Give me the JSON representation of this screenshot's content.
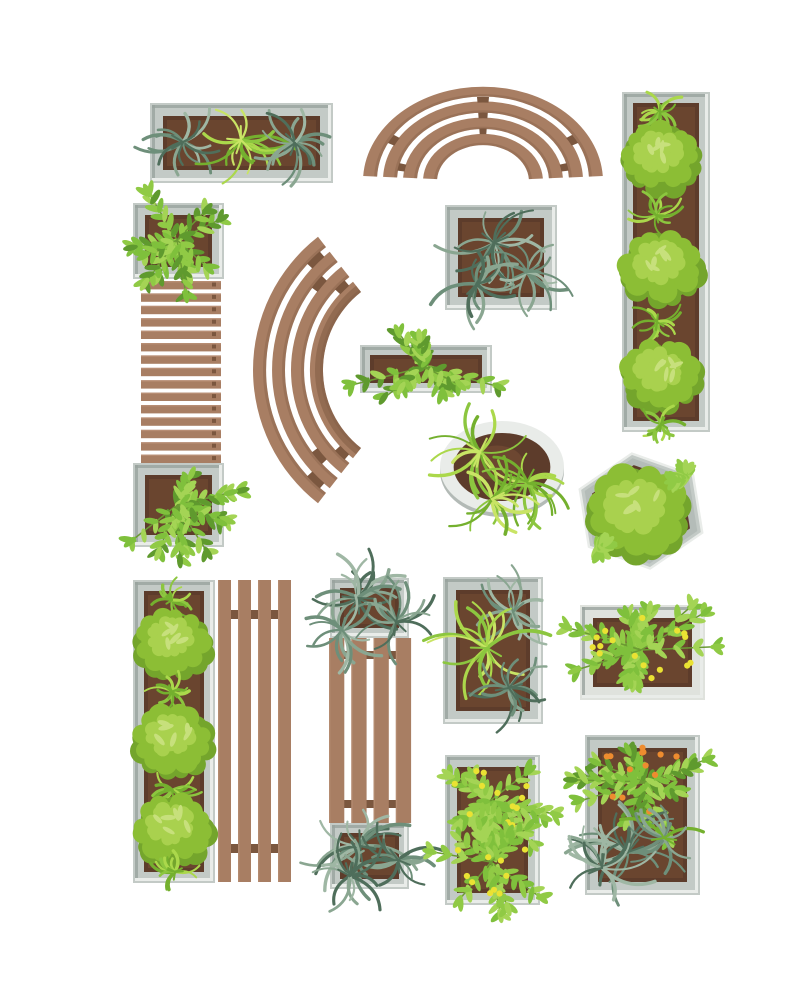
{
  "background": "#ffffff",
  "palette": {
    "wood": "#a87e63",
    "woodLight": "#bd947a",
    "woodDark": "#7b573f",
    "frame": "#c3cac6",
    "frameDark": "#99a39e",
    "frameHi": "#e9ece9",
    "frameWhite": "#dfe2dd",
    "soil": "#5d3c2b",
    "soilLight": "#7a5036",
    "bush": "#8cbe35",
    "bushDark": "#74a52c",
    "bushLight": "#a9d14e",
    "bushLeaf": "#c7e07c",
    "stem": "#6b9a33",
    "sage1": "#8aa691",
    "sage2": "#9fb7a4",
    "sage3": "#6e8f7a",
    "sage4": "#4f6e5b",
    "grass1": "#8cc63f",
    "grass2": "#abd84b",
    "grass3": "#74b02e",
    "grass4": "#c9e465",
    "leaf1": "#7fc03c",
    "leaf2": "#a4d455",
    "leaf3": "#5f9a2e",
    "leaf4": "#90ca45",
    "yellowBerry": "#eae233",
    "orangeBerry": "#ee8c2f"
  },
  "elements": [
    {
      "id": "planter-topleft-frame",
      "type": "rectPlanter",
      "x": 150,
      "y": 103,
      "w": 183,
      "h": 80,
      "inset": 13
    },
    {
      "id": "planter-topleft-plants",
      "type": "plants",
      "items": [
        {
          "kind": "spiky",
          "cx": 183,
          "cy": 142,
          "len": 46,
          "n": 16,
          "seed": 11,
          "colors": [
            "sage1",
            "sage2",
            "sage3",
            "sage4"
          ]
        },
        {
          "kind": "spiky",
          "cx": 241,
          "cy": 140,
          "len": 50,
          "n": 17,
          "seed": 12,
          "colors": [
            "grass1",
            "grass2",
            "grass3",
            "grass4"
          ]
        },
        {
          "kind": "spiky",
          "cx": 295,
          "cy": 143,
          "len": 46,
          "n": 16,
          "seed": 13,
          "colors": [
            "sage1",
            "sage2",
            "sage3",
            "sage4"
          ]
        }
      ]
    },
    {
      "id": "bench-arch",
      "type": "benchArc",
      "cx": 483,
      "cy": 181,
      "yscale": 0.79,
      "a0": 3,
      "a1": 177,
      "bands": [
        [
          120,
          106
        ],
        [
          100,
          86
        ],
        [
          80,
          66
        ],
        [
          60,
          46
        ]
      ],
      "ties": [
        {
          "gap": 0,
          "angles": [
            90,
            150,
            30
          ]
        },
        {
          "gap": 1,
          "angles": [
            90,
            168,
            12
          ]
        },
        {
          "gap": 2,
          "angles": [
            90
          ]
        }
      ]
    },
    {
      "id": "planter-tallright-frame",
      "type": "rectPlanter",
      "x": 622,
      "y": 92,
      "w": 88,
      "h": 340,
      "inset": 11
    },
    {
      "id": "planter-tallright-plants",
      "type": "plants",
      "items": [
        {
          "kind": "spiky",
          "cx": 660,
          "cy": 112,
          "len": 26,
          "n": 12,
          "seed": 21,
          "colors": [
            "grass1",
            "grass2",
            "grass3"
          ]
        },
        {
          "kind": "bush",
          "cx": 661,
          "cy": 158,
          "rx": 40,
          "ry": 33,
          "seed": 22
        },
        {
          "kind": "spiky",
          "cx": 656,
          "cy": 215,
          "len": 28,
          "n": 12,
          "seed": 23,
          "colors": [
            "grass1",
            "grass2",
            "grass3"
          ]
        },
        {
          "kind": "bush",
          "cx": 661,
          "cy": 268,
          "rx": 42,
          "ry": 34,
          "seed": 24
        },
        {
          "kind": "spiky",
          "cx": 657,
          "cy": 322,
          "len": 28,
          "n": 12,
          "seed": 25,
          "colors": [
            "grass1",
            "grass2",
            "grass3"
          ]
        },
        {
          "kind": "bush",
          "cx": 661,
          "cy": 375,
          "rx": 40,
          "ry": 33,
          "seed": 26
        },
        {
          "kind": "spiky",
          "cx": 661,
          "cy": 424,
          "len": 26,
          "n": 12,
          "seed": 27,
          "colors": [
            "grass1",
            "grass2",
            "grass3"
          ]
        }
      ]
    },
    {
      "id": "planter-left-top-frame",
      "type": "rectPlanter",
      "x": 133,
      "y": 203,
      "w": 91,
      "h": 76,
      "inset": 12
    },
    {
      "id": "planter-left-bottom-frame",
      "type": "rectPlanter",
      "x": 133,
      "y": 463,
      "w": 91,
      "h": 84,
      "inset": 12
    },
    {
      "id": "bench-straight-left",
      "type": "benchH",
      "x": 141,
      "y": 281,
      "w": 80,
      "h": 182,
      "slats": 15,
      "gap": 4,
      "nails": true
    },
    {
      "id": "planter-left-plants",
      "type": "plants",
      "items": [
        {
          "kind": "leafy",
          "cx": 177,
          "cy": 240,
          "rx": 52,
          "ry": 46,
          "branches": 10,
          "seed": 31,
          "colors": [
            "leaf1",
            "leaf2",
            "leaf3",
            "leaf4"
          ]
        },
        {
          "kind": "leafy",
          "cx": 177,
          "cy": 505,
          "rx": 52,
          "ry": 48,
          "branches": 10,
          "seed": 32,
          "colors": [
            "leaf1",
            "leaf2",
            "leaf3",
            "leaf4"
          ]
        }
      ]
    },
    {
      "id": "bench-curved",
      "type": "benchArc",
      "cx": 422,
      "cy": 370,
      "yscale": 1,
      "a0": 128,
      "a1": 232,
      "bands": [
        [
          169,
          156
        ],
        [
          150,
          137
        ],
        [
          131,
          118
        ],
        [
          112,
          99
        ]
      ],
      "ties": [
        {
          "gap": 0,
          "angles": [
            134,
            226
          ]
        },
        {
          "gap": 1,
          "angles": [
            140,
            220
          ]
        },
        {
          "gap": 2,
          "angles": [
            134,
            226
          ]
        }
      ],
      "innerShadow": [
        107,
        99
      ]
    },
    {
      "id": "planter-square-top-frame",
      "type": "rectPlanter",
      "x": 445,
      "y": 205,
      "w": 112,
      "h": 105,
      "inset": 13
    },
    {
      "id": "planter-square-top-plants",
      "type": "plants",
      "items": [
        {
          "kind": "spiky",
          "cx": 494,
          "cy": 243,
          "len": 54,
          "n": 17,
          "seed": 41,
          "colors": [
            "sage1",
            "sage2",
            "sage3",
            "sage4"
          ]
        },
        {
          "kind": "spiky",
          "cx": 527,
          "cy": 272,
          "len": 48,
          "n": 15,
          "seed": 42,
          "colors": [
            "sage1",
            "sage2",
            "sage3"
          ]
        },
        {
          "kind": "spiky",
          "cx": 477,
          "cy": 284,
          "len": 50,
          "n": 15,
          "seed": 43,
          "colors": [
            "sage1",
            "sage3",
            "sage4"
          ]
        }
      ]
    },
    {
      "id": "planter-small-frame",
      "type": "rectPlanter",
      "x": 360,
      "y": 345,
      "w": 132,
      "h": 48,
      "inset": 10
    },
    {
      "id": "planter-small-plants",
      "type": "plants",
      "items": [
        {
          "kind": "leafy",
          "cx": 424,
          "cy": 367,
          "rx": 66,
          "ry": 34,
          "branches": 11,
          "seed": 51,
          "colors": [
            "leaf1",
            "leaf2",
            "leaf3",
            "leaf4"
          ]
        }
      ]
    },
    {
      "id": "planter-round",
      "type": "roundPlanter",
      "cx": 502,
      "cy": 467,
      "rx": 62,
      "ry": 46
    },
    {
      "id": "planter-round-plants",
      "type": "plants",
      "items": [
        {
          "kind": "spiky",
          "cx": 480,
          "cy": 452,
          "len": 54,
          "n": 16,
          "seed": 61,
          "colors": [
            "grass1",
            "grass2",
            "grass3",
            "grass4"
          ]
        },
        {
          "kind": "spiky",
          "cx": 527,
          "cy": 482,
          "len": 50,
          "n": 15,
          "seed": 62,
          "colors": [
            "grass1",
            "grass2",
            "grass3"
          ]
        },
        {
          "kind": "spiky",
          "cx": 492,
          "cy": 499,
          "len": 48,
          "n": 14,
          "seed": 63,
          "colors": [
            "grass1",
            "grass3",
            "grass4"
          ]
        }
      ]
    },
    {
      "id": "planter-hex",
      "type": "hexPlanter",
      "cx": 641,
      "cy": 511,
      "rx": 66,
      "ry": 58,
      "rot": -8
    },
    {
      "id": "planter-hex-plants",
      "type": "plants",
      "items": [
        {
          "kind": "bush",
          "cx": 638,
          "cy": 512,
          "rx": 50,
          "ry": 44,
          "seed": 71
        },
        {
          "kind": "leafy",
          "cx": 598,
          "cy": 548,
          "rx": 16,
          "ry": 10,
          "branches": 2,
          "seed": 72,
          "colors": [
            "leaf2",
            "leaf4"
          ]
        },
        {
          "kind": "leafy",
          "cx": 686,
          "cy": 478,
          "rx": 14,
          "ry": 9,
          "branches": 2,
          "seed": 73,
          "colors": [
            "leaf2",
            "leaf4"
          ]
        }
      ]
    },
    {
      "id": "planter-tallleft-bottom-frame",
      "type": "rectPlanter",
      "x": 133,
      "y": 580,
      "w": 82,
      "h": 303,
      "inset": 11
    },
    {
      "id": "planter-tallleft-bottom-plants",
      "type": "plants",
      "items": [
        {
          "kind": "spiky",
          "cx": 172,
          "cy": 600,
          "len": 24,
          "n": 11,
          "seed": 81,
          "colors": [
            "grass1",
            "grass2",
            "grass3"
          ]
        },
        {
          "kind": "bush",
          "cx": 173,
          "cy": 643,
          "rx": 39,
          "ry": 32,
          "seed": 82
        },
        {
          "kind": "spiky",
          "cx": 172,
          "cy": 692,
          "len": 26,
          "n": 12,
          "seed": 83,
          "colors": [
            "grass1",
            "grass2",
            "grass3"
          ]
        },
        {
          "kind": "bush",
          "cx": 173,
          "cy": 741,
          "rx": 41,
          "ry": 33,
          "seed": 84
        },
        {
          "kind": "spiky",
          "cx": 172,
          "cy": 790,
          "len": 26,
          "n": 12,
          "seed": 85,
          "colors": [
            "grass1",
            "grass2",
            "grass3"
          ]
        },
        {
          "kind": "bush",
          "cx": 173,
          "cy": 830,
          "rx": 40,
          "ry": 33,
          "seed": 86
        },
        {
          "kind": "spiky",
          "cx": 175,
          "cy": 872,
          "len": 28,
          "n": 12,
          "seed": 87,
          "colors": [
            "grass1",
            "grass2",
            "grass3"
          ]
        }
      ]
    },
    {
      "id": "bench-vertical-4slat",
      "type": "benchV",
      "x": 218,
      "y": 580,
      "w": 73,
      "h": 302,
      "slats": 4,
      "gap": 7,
      "rails": [
        610,
        844
      ],
      "railH": 9
    },
    {
      "id": "combo-mid-top-frame",
      "type": "rectPlanter",
      "x": 330,
      "y": 578,
      "w": 79,
      "h": 60,
      "inset": 10
    },
    {
      "id": "combo-mid-bottom-frame",
      "type": "rectPlanter",
      "x": 330,
      "y": 823,
      "w": 79,
      "h": 66,
      "inset": 10
    },
    {
      "id": "bench-mid-vertical",
      "type": "benchV",
      "x": 329,
      "y": 638,
      "w": 82,
      "h": 185,
      "slats": 4,
      "gap": 7,
      "rails": [
        651,
        800
      ],
      "railH": 8
    },
    {
      "id": "combo-mid-plants",
      "type": "plants",
      "items": [
        {
          "kind": "spiky",
          "cx": 358,
          "cy": 598,
          "len": 56,
          "n": 18,
          "seed": 91,
          "colors": [
            "sage1",
            "sage2",
            "sage3",
            "sage4"
          ]
        },
        {
          "kind": "spiky",
          "cx": 396,
          "cy": 622,
          "len": 48,
          "n": 15,
          "seed": 92,
          "colors": [
            "sage1",
            "sage3",
            "sage4"
          ]
        },
        {
          "kind": "spiky",
          "cx": 342,
          "cy": 630,
          "len": 44,
          "n": 14,
          "seed": 93,
          "colors": [
            "sage1",
            "sage2",
            "sage3"
          ]
        },
        {
          "kind": "spiky",
          "cx": 360,
          "cy": 846,
          "len": 56,
          "n": 18,
          "seed": 94,
          "colors": [
            "sage1",
            "sage2",
            "sage3",
            "sage4"
          ]
        },
        {
          "kind": "spiky",
          "cx": 398,
          "cy": 860,
          "len": 46,
          "n": 15,
          "seed": 95,
          "colors": [
            "sage1",
            "sage3",
            "sage4"
          ]
        },
        {
          "kind": "spiky",
          "cx": 350,
          "cy": 876,
          "len": 48,
          "n": 15,
          "seed": 96,
          "colors": [
            "sage1",
            "sage2",
            "sage4"
          ]
        }
      ]
    },
    {
      "id": "planter-mid-spiky-frame",
      "type": "rectPlanter",
      "x": 443,
      "y": 577,
      "w": 100,
      "h": 147,
      "inset": 13
    },
    {
      "id": "planter-mid-spiky-plants",
      "type": "plants",
      "items": [
        {
          "kind": "spiky",
          "cx": 513,
          "cy": 612,
          "len": 50,
          "n": 16,
          "seed": 101,
          "colors": [
            "sage1",
            "sage2",
            "sage3"
          ]
        },
        {
          "kind": "spiky",
          "cx": 487,
          "cy": 648,
          "len": 58,
          "n": 18,
          "seed": 102,
          "colors": [
            "grass4",
            "grass2",
            "grass1"
          ]
        },
        {
          "kind": "spiky",
          "cx": 509,
          "cy": 688,
          "len": 48,
          "n": 15,
          "seed": 103,
          "colors": [
            "sage1",
            "sage3",
            "sage4"
          ]
        }
      ]
    },
    {
      "id": "planter-sq-yellow-frame",
      "type": "rectPlanter",
      "x": 580,
      "y": 605,
      "w": 125,
      "h": 95,
      "inset": 13,
      "light": true
    },
    {
      "id": "planter-sq-yellow-plants",
      "type": "plants",
      "items": [
        {
          "kind": "leafy",
          "cx": 641,
          "cy": 650,
          "rx": 64,
          "ry": 46,
          "branches": 12,
          "seed": 111,
          "colors": [
            "leaf1",
            "leaf2",
            "leaf4"
          ],
          "berry": "yellowBerry",
          "berryN": 16
        }
      ]
    },
    {
      "id": "planter-bottom-mid-frame",
      "type": "rectPlanter",
      "x": 445,
      "y": 755,
      "w": 95,
      "h": 150,
      "inset": 12
    },
    {
      "id": "planter-bottom-mid-plants",
      "type": "plants",
      "items": [
        {
          "kind": "leafy",
          "cx": 491,
          "cy": 800,
          "rx": 52,
          "ry": 46,
          "branches": 10,
          "seed": 121,
          "colors": [
            "leaf1",
            "leaf2",
            "leaf4"
          ],
          "berry": "yellowBerry",
          "berryN": 12
        },
        {
          "kind": "leafy",
          "cx": 491,
          "cy": 862,
          "rx": 52,
          "ry": 42,
          "branches": 9,
          "seed": 122,
          "colors": [
            "leaf1",
            "leaf2",
            "leaf4"
          ],
          "berry": "yellowBerry",
          "berryN": 10
        }
      ]
    },
    {
      "id": "planter-bottom-right-frame",
      "type": "rectPlanter",
      "x": 585,
      "y": 735,
      "w": 115,
      "h": 160,
      "inset": 13
    },
    {
      "id": "planter-bottom-right-plants",
      "type": "plants",
      "items": [
        {
          "kind": "leafy",
          "cx": 644,
          "cy": 782,
          "rx": 58,
          "ry": 48,
          "branches": 11,
          "seed": 131,
          "colors": [
            "leaf1",
            "leaf2",
            "leaf3"
          ],
          "berry": "orangeBerry",
          "berryN": 13
        },
        {
          "kind": "spiky",
          "cx": 628,
          "cy": 852,
          "len": 58,
          "n": 18,
          "seed": 132,
          "colors": [
            "sage1",
            "sage2",
            "sage3",
            "sage4"
          ]
        },
        {
          "kind": "spiky",
          "cx": 664,
          "cy": 838,
          "len": 44,
          "n": 14,
          "seed": 133,
          "colors": [
            "sage1",
            "sage3",
            "grass3"
          ]
        },
        {
          "kind": "spiky",
          "cx": 602,
          "cy": 868,
          "len": 50,
          "n": 15,
          "seed": 134,
          "colors": [
            "sage1",
            "sage2",
            "sage4"
          ]
        }
      ]
    }
  ]
}
